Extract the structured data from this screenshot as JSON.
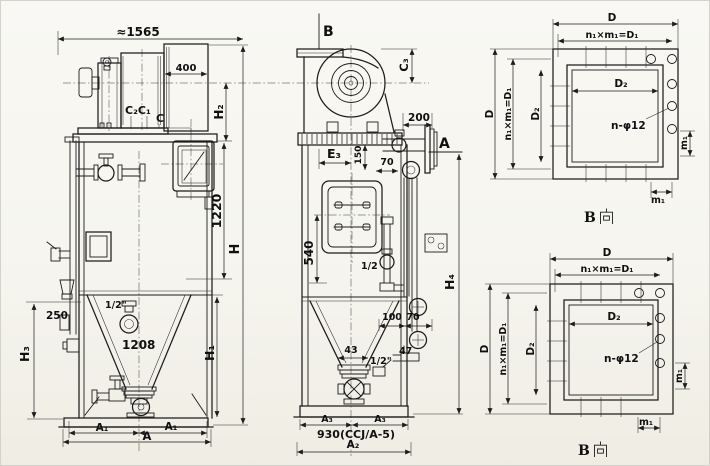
{
  "colors": {
    "paper": "#f7f6f0",
    "ink": "#1c1c1c"
  },
  "front_view": {
    "overall_width": "≈1565",
    "motor_box_width": "400",
    "label_c2c1": "C₂C₁",
    "label_c": "C",
    "dim_h2": "H₂",
    "dim_1220": "1220",
    "dim_h": "H",
    "dim_250": "250",
    "dim_h3": "H₃",
    "drain_size": "1/2\"",
    "outlet_dia": "1208",
    "dim_h1": "H₁",
    "dim_a1_left": "A₁",
    "dim_a1_right": "A₁",
    "dim_a": "A"
  },
  "side_view": {
    "view_arrow_b": "B",
    "dim_c3": "C₃",
    "dim_200": "200",
    "section_a": "A",
    "dim_e3": "E₃",
    "dim_150": "150",
    "dim_70_top": "70",
    "dim_540": "540",
    "valve_size_mid": "1/2",
    "dim_h4": "H₄",
    "dim_100": "100",
    "dim_70_bottom": "70",
    "dim_43": "43",
    "dim_47": "47",
    "valve_size_bottom": "1/2\"",
    "dim_a3_left": "A₃",
    "dim_a3_right": "A₃",
    "base_width_note": "930(CCJ/A-5)",
    "dim_a2": "A₂"
  },
  "flange_view_top": {
    "dim_d_top": "D",
    "bolt_pitch_top": "n₁×m₁=D₁",
    "dim_d2_h": "D₂",
    "dim_d_left": "D",
    "bolt_pitch_left": "n₁×m₁=D₁",
    "dim_d2_v": "D₂",
    "bolt_holes": "n-φ12",
    "dim_m1_bottom": "m₁",
    "dim_m1_right": "m₁",
    "view_label": "B向",
    "view_label_b": "B",
    "view_label_xiang": "向"
  },
  "flange_view_bottom": {
    "dim_d_top": "D",
    "bolt_pitch_top": "n₁×m₁=D₁",
    "dim_d2_h": "D₂",
    "dim_d_left": "D",
    "bolt_pitch_left": "n₁×m₁=D₁",
    "dim_d2_v": "D₂",
    "bolt_holes": "n-φ12",
    "dim_m1_bottom": "m₁",
    "dim_m1_right": "m₁",
    "view_label": "B向",
    "view_label_b": "B",
    "view_label_xiang": "向"
  }
}
